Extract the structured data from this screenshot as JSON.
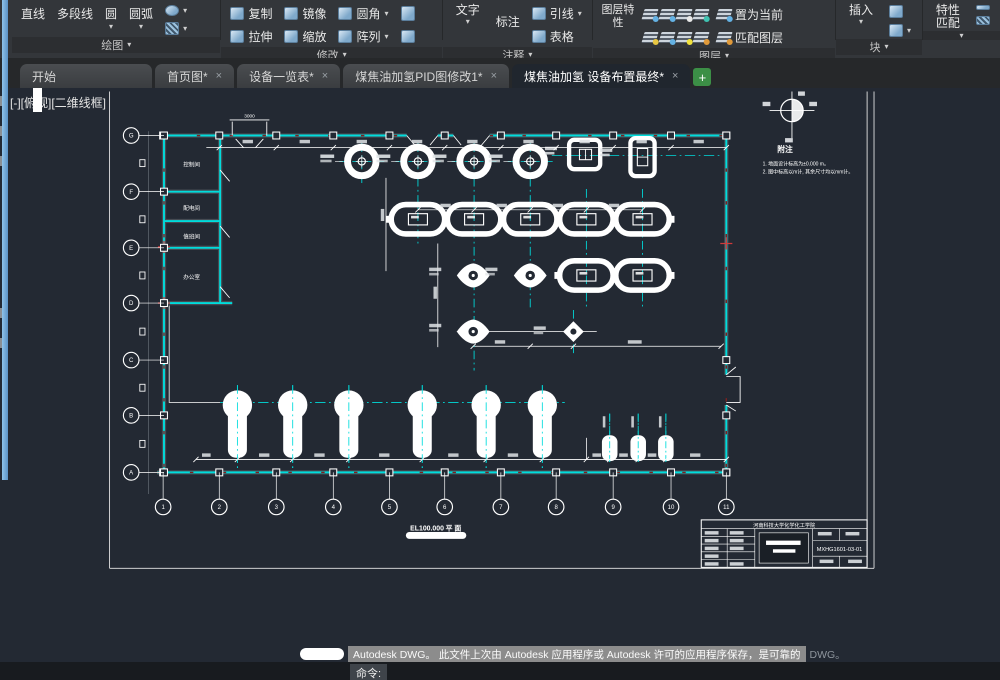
{
  "app": {
    "bg": "#232933",
    "accent_cyan": "#00dcdc",
    "line_white": "#ffffff",
    "red_mark": "#d03a3a"
  },
  "ribbon": {
    "draw": {
      "panel": "绘图",
      "line": "直线",
      "polyline": "多段线",
      "circle": "圆",
      "arc": "圆弧"
    },
    "modify": {
      "panel": "修改",
      "copy": "复制",
      "mirror": "镜像",
      "fillet": "圆角",
      "stretch": "拉伸",
      "scale": "缩放",
      "array": "阵列"
    },
    "annotate": {
      "panel": "注释",
      "text": "文字",
      "dimension": "标注",
      "leader": "引线",
      "table": "表格"
    },
    "layer": {
      "panel": "图层",
      "properties": "图层特性",
      "set_current": "置为当前",
      "match": "匹配图层"
    },
    "block": {
      "panel": "块",
      "insert": "插入"
    },
    "properties": {
      "match_props": "特性匹配"
    }
  },
  "tabs": {
    "start": "开始",
    "t1": "首页图*",
    "t2": "设备一览表*",
    "t3": "煤焦油加氢PID图修改1*",
    "t4": "煤焦油加氢 设备布置最终*",
    "new_tab": "+"
  },
  "viewport": {
    "controls": "[-][俯视][二维线框]"
  },
  "drawing": {
    "rooms": [
      "控制间",
      "配电间",
      "值班间",
      "办公室"
    ],
    "grid": {
      "cols": [
        "1",
        "2",
        "3",
        "4",
        "5",
        "6",
        "7",
        "8",
        "9",
        "10",
        "11"
      ],
      "rows": [
        "G",
        "F",
        "E",
        "D",
        "C",
        "B",
        "A"
      ]
    },
    "dims": {
      "porch": "3000"
    },
    "plan_label": {
      "elevation": "EL100.000",
      "suffix": "平 面"
    },
    "notes": {
      "title": "附注",
      "line1": "1. 地面设计标高为±0.000 m。",
      "line2": "2. 图中标高以m计, 其余尺寸均以mm计。"
    },
    "title_block": {
      "header": "河南科技大学化学化工学院",
      "drawing_no": "MXHG1601-03-01"
    }
  },
  "statusbar": {
    "notification": "Autodesk DWG。  此文件上次由 Autodesk 应用程序或 Autodesk 许可的应用程序保存，是可靠的",
    "suffix": "DWG。",
    "command": "命令:"
  }
}
